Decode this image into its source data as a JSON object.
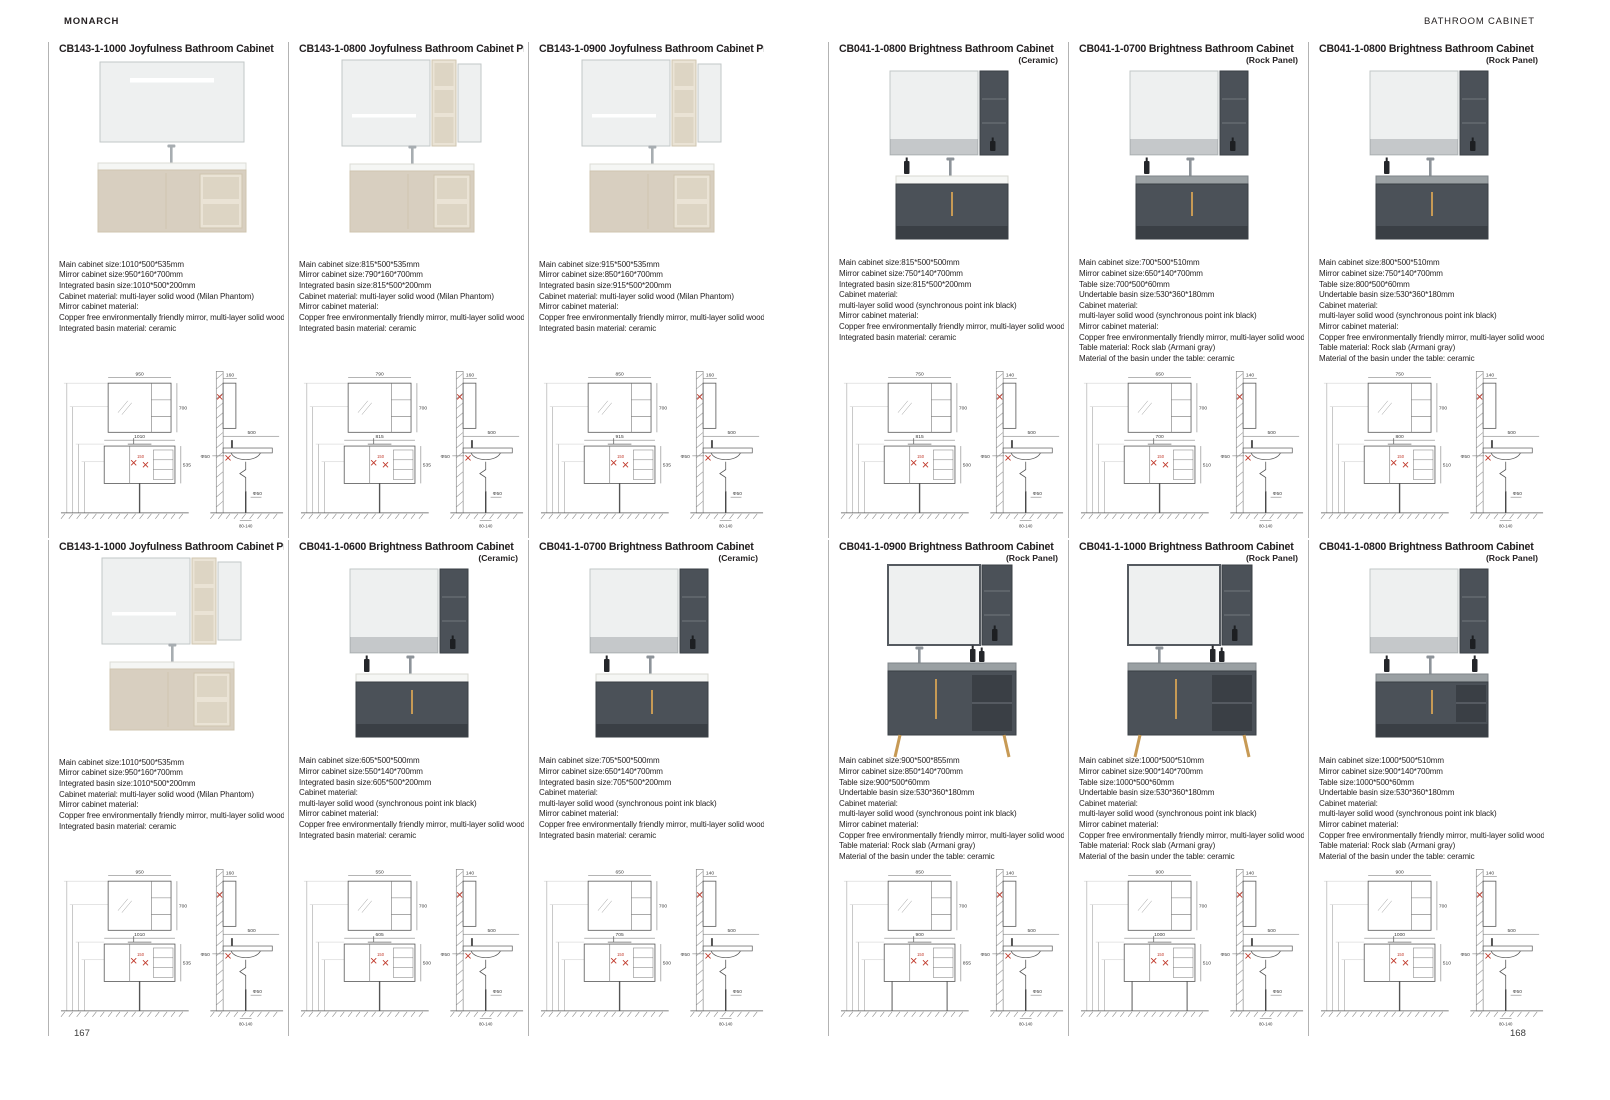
{
  "header": {
    "left": "MONARCH",
    "right": "BATHROOM CABINET"
  },
  "footer": {
    "left_page": "167",
    "right_page": "168"
  },
  "colors": {
    "beige": "#d8cfc0",
    "beige_light": "#eae3d5",
    "beige_shadow": "#cfc4af",
    "mirror": "#eef0f0",
    "mirror_edge": "#c2c7c7",
    "dark": "#4b5158",
    "darker": "#3a3f45",
    "white_top": "#f5f6f4",
    "rock_top": "#9aa0a3",
    "gold": "#c79a55",
    "line": "#6f6f6f",
    "red": "#c0392b",
    "text": "#3a3a3a"
  },
  "drawing_common": {
    "mirror_h": "700",
    "side_w": "500",
    "drain": "Φ50",
    "gap": "80-140",
    "handle": "150"
  },
  "products": [
    {
      "code": "CB143-1-1000",
      "name": "Joyfulness Bathroom Cabinet",
      "variant": "",
      "style": "joyWide",
      "col": 0,
      "row": 0,
      "specs": [
        "Main cabinet size:1010*500*535mm",
        "Mirror cabinet size:950*160*700mm",
        "Integrated basin size:1010*500*200mm",
        "Cabinet material: multi-layer solid wood (Milan Phantom)",
        "Mirror cabinet material:",
        "Copper free environmentally friendly mirror, multi-layer solid wood",
        "Integrated basin material: ceramic"
      ],
      "drawing": {
        "mirror_w": "950",
        "cab_w": "1010",
        "cab_h": "535",
        "depth": "160"
      }
    },
    {
      "code": "CB143-1-0800",
      "name": "Joyfulness Bathroom Cabinet Pro",
      "variant": "",
      "style": "joyShelf",
      "col": 1,
      "row": 0,
      "specs": [
        "Main cabinet size:815*500*535mm",
        "Mirror cabinet size:790*160*700mm",
        "Integrated basin size:815*500*200mm",
        "Cabinet material: multi-layer solid wood (Milan Phantom)",
        "Mirror cabinet material:",
        "Copper free environmentally friendly mirror, multi-layer solid wood",
        "Integrated basin material: ceramic"
      ],
      "drawing": {
        "mirror_w": "790",
        "cab_w": "815",
        "cab_h": "535",
        "depth": "160"
      }
    },
    {
      "code": "CB143-1-0900",
      "name": "Joyfulness Bathroom Cabinet Pro",
      "variant": "",
      "style": "joyShelf",
      "col": 2,
      "row": 0,
      "specs": [
        "Main cabinet size:915*500*535mm",
        "Mirror cabinet size:850*160*700mm",
        "Integrated basin size:915*500*200mm",
        "Cabinet material: multi-layer solid wood (Milan Phantom)",
        "Mirror cabinet material:",
        "Copper free environmentally friendly mirror, multi-layer solid wood",
        "Integrated basin material: ceramic"
      ],
      "drawing": {
        "mirror_w": "850",
        "cab_w": "915",
        "cab_h": "535",
        "depth": "160"
      }
    },
    {
      "code": "CB041-1-0800",
      "name": "Brightness Bathroom Cabinet",
      "variant": "(Ceramic)",
      "style": "brightCeramic",
      "col": 3,
      "row": 0,
      "specs": [
        "Main cabinet size:815*500*500mm",
        "Mirror cabinet size:750*140*700mm",
        "Integrated basin size:815*500*200mm",
        "Cabinet material:",
        "multi-layer solid wood (synchronous point ink black)",
        "Mirror cabinet material:",
        "Copper free environmentally friendly mirror, multi-layer solid wood",
        "Integrated basin material: ceramic"
      ],
      "drawing": {
        "mirror_w": "750",
        "cab_w": "815",
        "cab_h": "500",
        "depth": "140"
      }
    },
    {
      "code": "CB041-1-0700",
      "name": "Brightness Bathroom Cabinet",
      "variant": "(Rock Panel)",
      "style": "brightRock",
      "col": 4,
      "row": 0,
      "specs": [
        "Main cabinet size:700*500*510mm",
        "Mirror cabinet size:650*140*700mm",
        "Table size:700*500*60mm",
        "Undertable basin size:530*360*180mm",
        "Cabinet material:",
        "multi-layer solid wood (synchronous point ink black)",
        "Mirror cabinet material:",
        "Copper free environmentally friendly mirror, multi-layer solid wood",
        "Table material: Rock slab (Armani gray)",
        "Material of the basin under the table: ceramic"
      ],
      "drawing": {
        "mirror_w": "650",
        "cab_w": "700",
        "cab_h": "510",
        "depth": "140"
      }
    },
    {
      "code": "CB041-1-0800",
      "name": "Brightness Bathroom Cabinet",
      "variant": "(Rock Panel)",
      "style": "brightRock",
      "col": 5,
      "row": 0,
      "specs": [
        "Main cabinet size:800*500*510mm",
        "Mirror cabinet size:750*140*700mm",
        "Table size:800*500*60mm",
        "Undertable basin size:530*360*180mm",
        "Cabinet material:",
        "multi-layer solid wood (synchronous point ink black)",
        "Mirror cabinet material:",
        "Copper free environmentally friendly mirror, multi-layer solid wood",
        "Table material: Rock slab (Armani gray)",
        "Material of the basin under the table: ceramic"
      ],
      "drawing": {
        "mirror_w": "750",
        "cab_w": "800",
        "cab_h": "510",
        "depth": "140"
      }
    },
    {
      "code": "CB143-1-1000",
      "name": "Joyfulness Bathroom Cabinet Pro",
      "variant": "",
      "style": "joyShelf",
      "col": 0,
      "row": 1,
      "specs": [
        "Main cabinet size:1010*500*535mm",
        "Mirror cabinet size:950*160*700mm",
        "Integrated basin size:1010*500*200mm",
        "Cabinet material: multi-layer solid wood (Milan Phantom)",
        "Mirror cabinet material:",
        "Copper free environmentally friendly mirror, multi-layer solid wood",
        "Integrated basin material: ceramic"
      ],
      "drawing": {
        "mirror_w": "950",
        "cab_w": "1010",
        "cab_h": "535",
        "depth": "160"
      }
    },
    {
      "code": "CB041-1-0600",
      "name": "Brightness Bathroom Cabinet",
      "variant": "(Ceramic)",
      "style": "brightCeramic",
      "col": 1,
      "row": 1,
      "specs": [
        "Main cabinet size:605*500*500mm",
        "Mirror cabinet size:550*140*700mm",
        "Integrated basin size:605*500*200mm",
        "Cabinet material:",
        "multi-layer solid wood (synchronous point ink black)",
        "Mirror cabinet material:",
        "Copper free environmentally friendly mirror, multi-layer solid wood",
        "Integrated basin material: ceramic"
      ],
      "drawing": {
        "mirror_w": "550",
        "cab_w": "605",
        "cab_h": "500",
        "depth": "140"
      }
    },
    {
      "code": "CB041-1-0700",
      "name": "Brightness Bathroom Cabinet",
      "variant": "(Ceramic)",
      "style": "brightCeramic",
      "col": 2,
      "row": 1,
      "specs": [
        "Main cabinet size:705*500*500mm",
        "Mirror cabinet size:650*140*700mm",
        "Integrated basin size:705*500*200mm",
        "Cabinet material:",
        "multi-layer solid wood (synchronous point ink black)",
        "Mirror cabinet material:",
        "Copper free environmentally friendly mirror, multi-layer solid wood",
        "Integrated basin material: ceramic"
      ],
      "drawing": {
        "mirror_w": "650",
        "cab_w": "705",
        "cab_h": "500",
        "depth": "140"
      }
    },
    {
      "code": "CB041-1-0900",
      "name": "Brightness Bathroom Cabinet",
      "variant": "(Rock Panel)",
      "style": "brightRockLegs",
      "col": 3,
      "row": 1,
      "specs": [
        "Main cabinet size:900*500*855mm",
        "Mirror cabinet size:850*140*700mm",
        "Table size:900*500*60mm",
        "Undertable basin size:530*360*180mm",
        "Cabinet material:",
        "multi-layer solid wood (synchronous point ink black)",
        "Mirror cabinet material:",
        "Copper free environmentally friendly mirror, multi-layer solid wood",
        "Table material: Rock slab (Armani gray)",
        "Material of the basin under the table: ceramic"
      ],
      "drawing": {
        "mirror_w": "850",
        "cab_w": "900",
        "cab_h": "855",
        "depth": "140"
      }
    },
    {
      "code": "CB041-1-1000",
      "name": "Brightness Bathroom Cabinet",
      "variant": "(Rock Panel)",
      "style": "brightRockLegs",
      "col": 4,
      "row": 1,
      "specs": [
        "Main cabinet size:1000*500*510mm",
        "Mirror cabinet size:900*140*700mm",
        "Table size:1000*500*60mm",
        "Undertable basin size:530*360*180mm",
        "Cabinet material:",
        "multi-layer solid wood (synchronous point ink black)",
        "Mirror cabinet material:",
        "Copper free environmentally friendly mirror, multi-layer solid wood",
        "Table material: Rock slab (Armani gray)",
        "Material of the basin under the table: ceramic"
      ],
      "drawing": {
        "mirror_w": "900",
        "cab_w": "1000",
        "cab_h": "510",
        "depth": "140"
      }
    },
    {
      "code": "CB041-1-0800",
      "name": "Brightness Bathroom Cabinet",
      "variant": "(Rock Panel)",
      "style": "brightRockShelf",
      "col": 5,
      "row": 1,
      "specs": [
        "Main cabinet size:1000*500*510mm",
        "Mirror cabinet size:900*140*700mm",
        "Table size:1000*500*60mm",
        "Undertable basin size:530*360*180mm",
        "Cabinet material:",
        "multi-layer solid wood (synchronous point ink black)",
        "Mirror cabinet material:",
        "Copper free environmentally friendly mirror, multi-layer solid wood",
        "Table material: Rock slab (Armani gray)",
        "Material of the basin under the table: ceramic"
      ],
      "drawing": {
        "mirror_w": "900",
        "cab_w": "1000",
        "cab_h": "510",
        "depth": "140"
      }
    }
  ]
}
